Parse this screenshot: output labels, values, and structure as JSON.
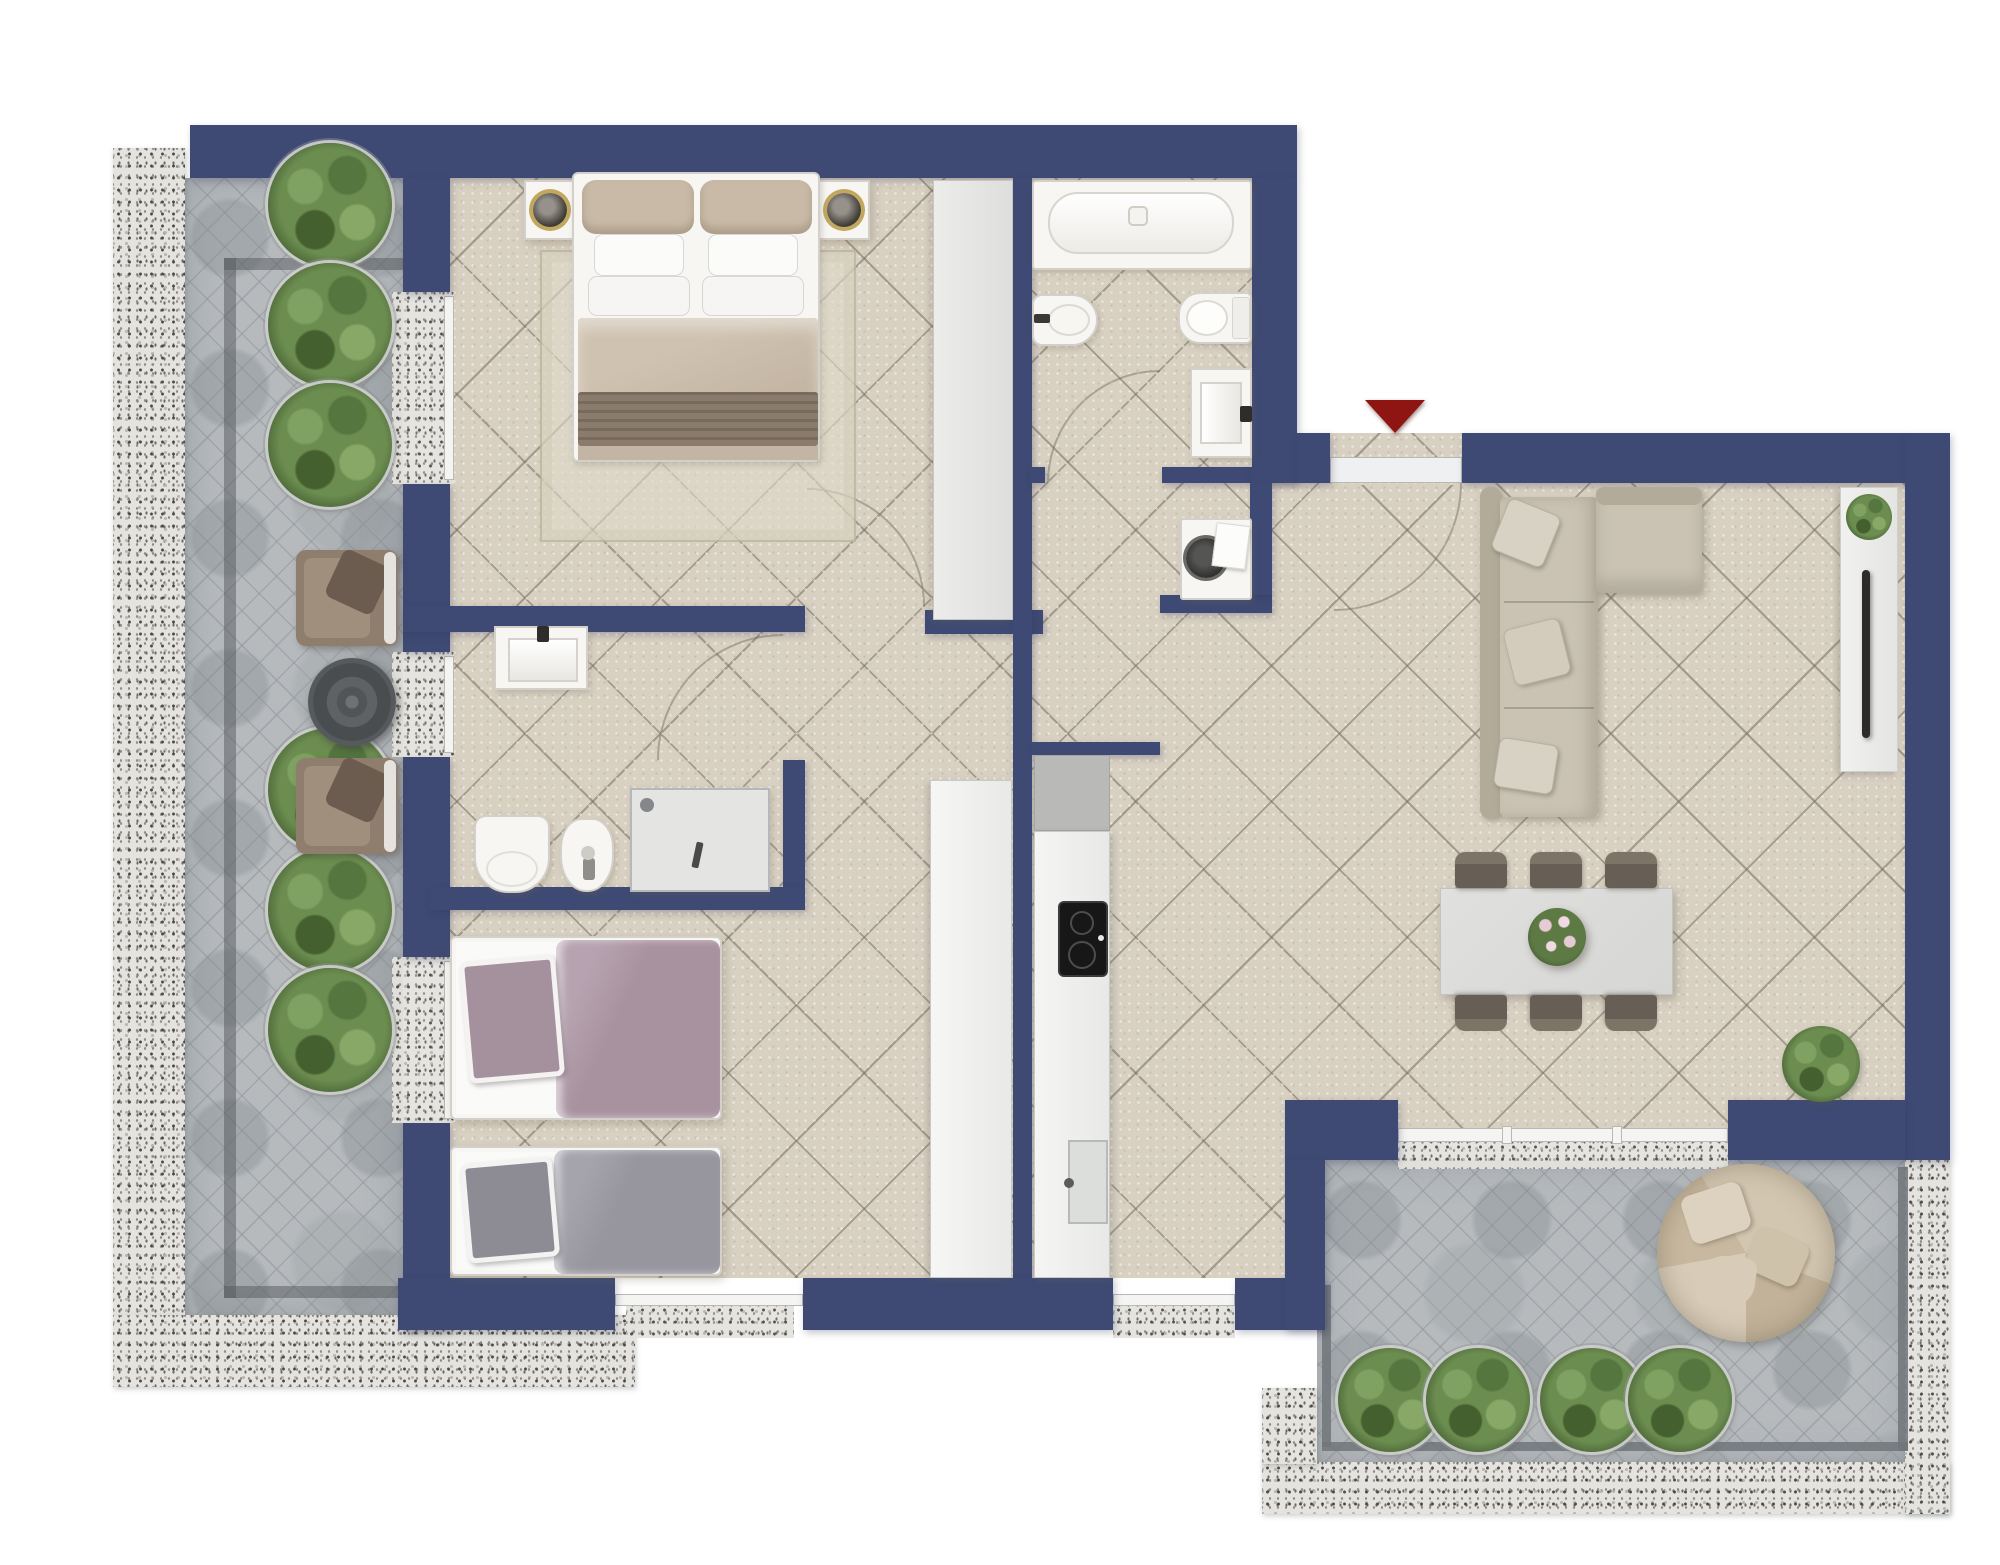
{
  "title": "Apartment floor plan (top view render)",
  "colors": {
    "wall": "#3e4a74",
    "interior_floor": "#d8d0c1",
    "terrace_floor": "#b6babd",
    "granite_border": "#e4e3df",
    "entry_arrow": "#8e1511",
    "fixtures": "#f7f6f3",
    "sofa": "#c7c0b0",
    "bed_master_duvet": "#c7b9a6",
    "bed_single_1": "#a8929f",
    "bed_single_2": "#97969f"
  },
  "entrance": {
    "label": "Entrance",
    "marker": "red-arrow-down"
  },
  "rooms": [
    {
      "id": "master-bedroom",
      "label": "Master Bedroom"
    },
    {
      "id": "bathroom-main",
      "label": "Main Bathroom"
    },
    {
      "id": "hallway",
      "label": "Hallway"
    },
    {
      "id": "laundry-niche",
      "label": "Laundry Niche"
    },
    {
      "id": "second-bathroom",
      "label": "Second Bathroom"
    },
    {
      "id": "twin-bedroom",
      "label": "Twin Bedroom"
    },
    {
      "id": "kitchen",
      "label": "Kitchen"
    },
    {
      "id": "living-dining",
      "label": "Living / Dining Room"
    },
    {
      "id": "terrace-left",
      "label": "Side Terrace"
    },
    {
      "id": "terrace-bottom",
      "label": "Lower Terrace"
    }
  ],
  "furniture": {
    "double_bed": "Double bed with nightstands and lamps",
    "wardrobe_bedroom": "Bedroom wardrobe",
    "wardrobe_hall": "Hallway wardrobe",
    "bathtub": "Bathtub",
    "toilet": "Toilet",
    "bidet": "Bidet",
    "washbasin": "Washbasin",
    "washing_machine": "Washing machine",
    "shower": "Shower enclosure",
    "single_bed_1": "Single bed (mauve)",
    "single_bed_2": "Single bed (grey)",
    "kitchen_counter": "Kitchen counter",
    "cooktop": "Cooktop",
    "kitchen_sink": "Kitchen sink",
    "sectional_sofa": "L-shaped sectional sofa",
    "tv_unit": "TV sideboard",
    "tv": "Television",
    "dining_table": "Dining table",
    "dining_chairs": "Dining chairs",
    "flower_centerpiece": "Flower centerpiece",
    "potted_plant": "Potted plant",
    "armchairs": "Terrace armchairs",
    "coffee_table": "Round coffee table",
    "round_daybed": "Round day-bed",
    "planters": "Round planters"
  },
  "counts": {
    "planters_side_terrace": 6,
    "planters_lower_terrace": 4,
    "dining_chairs": 6,
    "terrace_armchairs": 2,
    "single_beds": 2,
    "windows_west_wall": 3
  }
}
